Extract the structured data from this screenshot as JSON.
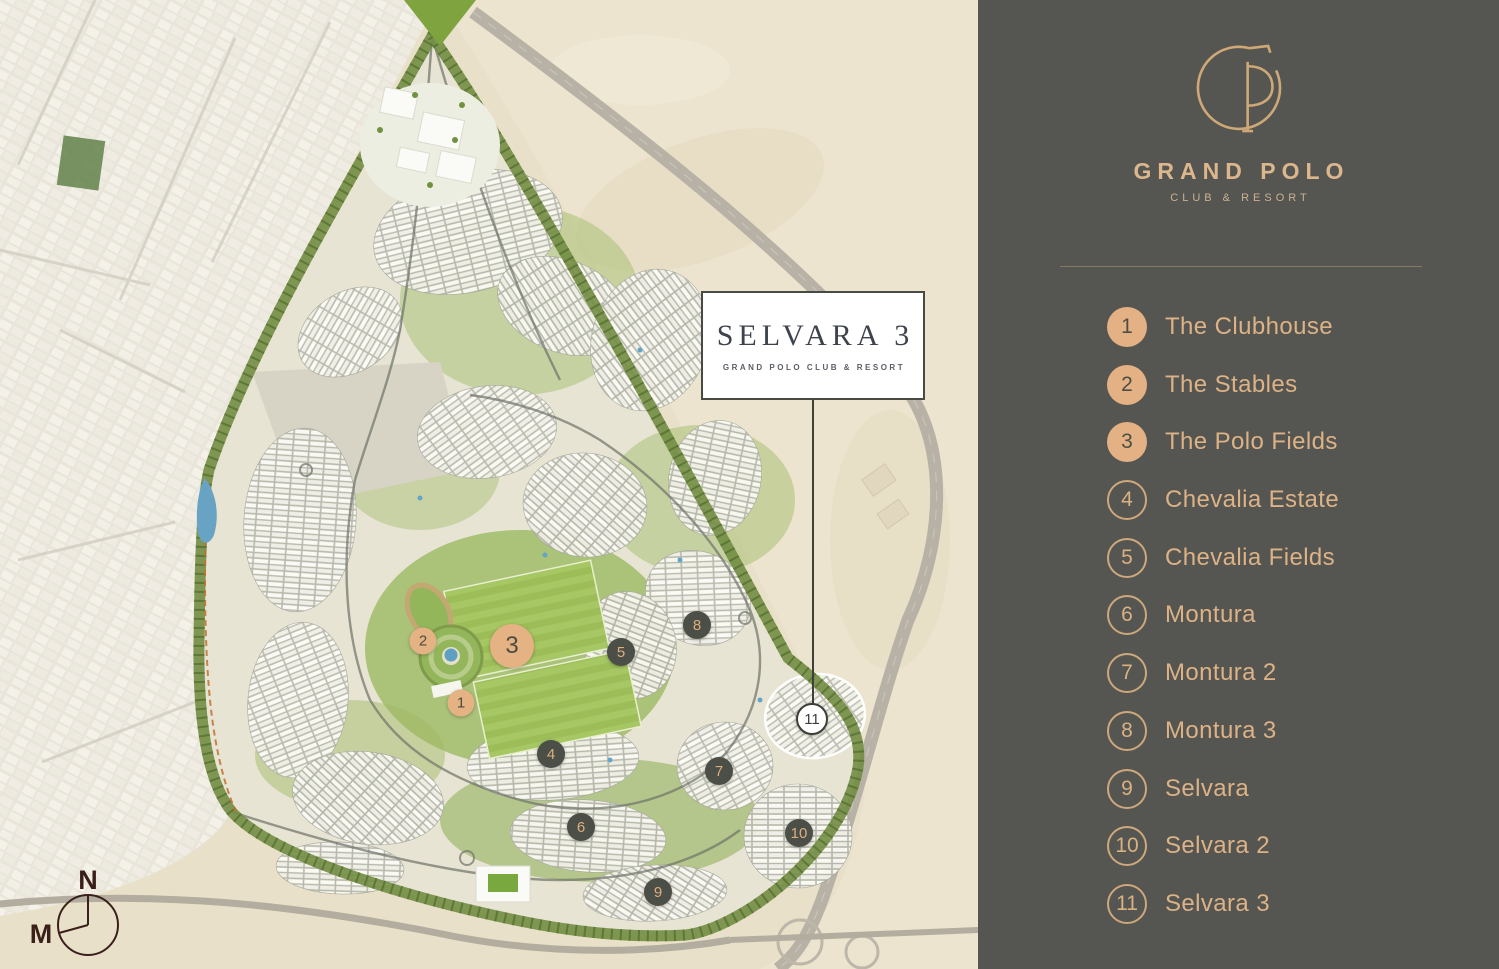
{
  "sidebar": {
    "background_color": "#555651",
    "accent_color": "#e3b183",
    "brand": {
      "logo_icon": "gp-monogram-icon",
      "name": "GRAND POLO",
      "tagline": "CLUB & RESORT"
    },
    "legend": {
      "items": [
        {
          "num": "1",
          "label": "The Clubhouse",
          "filled": true
        },
        {
          "num": "2",
          "label": "The Stables",
          "filled": true
        },
        {
          "num": "3",
          "label": "The Polo Fields",
          "filled": true
        },
        {
          "num": "4",
          "label": "Chevalia Estate",
          "filled": false
        },
        {
          "num": "5",
          "label": "Chevalia Fields",
          "filled": false
        },
        {
          "num": "6",
          "label": "Montura",
          "filled": false
        },
        {
          "num": "7",
          "label": "Montura 2",
          "filled": false
        },
        {
          "num": "8",
          "label": "Montura 3",
          "filled": false
        },
        {
          "num": "9",
          "label": "Selvara",
          "filled": false
        },
        {
          "num": "10",
          "label": "Selvara 2",
          "filled": false
        },
        {
          "num": "11",
          "label": "Selvara 3",
          "filled": false
        }
      ]
    }
  },
  "map": {
    "callout": {
      "title": "SELVARA 3",
      "subtitle": "GRAND POLO CLUB & RESORT"
    },
    "compass": {
      "north": "N",
      "magnetic": "M"
    },
    "markers": [
      {
        "num": "1",
        "style": "highlight"
      },
      {
        "num": "2",
        "style": "highlight"
      },
      {
        "num": "3",
        "style": "highlight-large"
      },
      {
        "num": "4",
        "style": "dark"
      },
      {
        "num": "5",
        "style": "dark"
      },
      {
        "num": "6",
        "style": "dark"
      },
      {
        "num": "7",
        "style": "dark"
      },
      {
        "num": "8",
        "style": "dark"
      },
      {
        "num": "9",
        "style": "dark"
      },
      {
        "num": "10",
        "style": "dark"
      },
      {
        "num": "11",
        "style": "white-outline"
      }
    ],
    "colors": {
      "desert": "#e9e0c9",
      "development_green": "#9cb961",
      "polo_field": "#a6c763",
      "marker_dark": "#4b4f47",
      "marker_tan": "#e5b284",
      "water": "#5f9fc2"
    }
  }
}
